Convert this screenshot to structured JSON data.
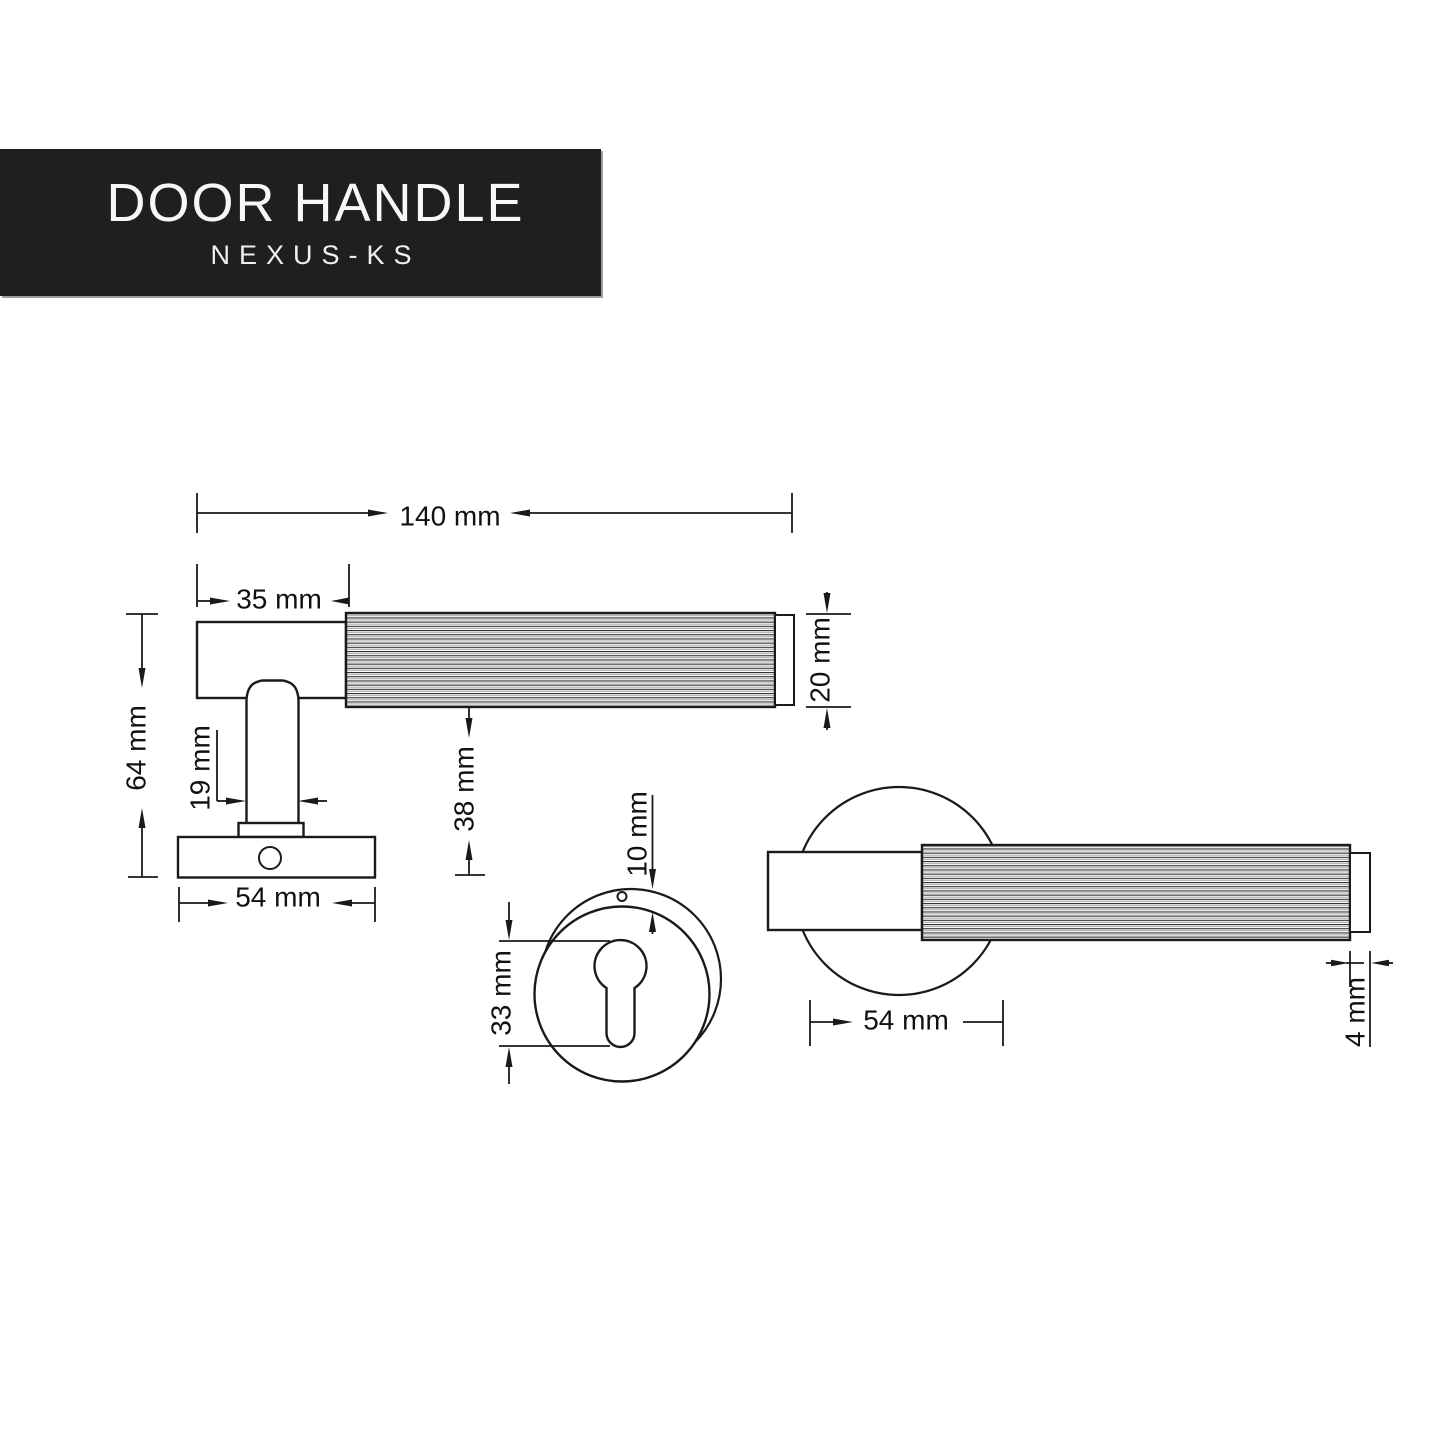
{
  "banner": {
    "title": "DOOR HANDLE",
    "subtitle": "NEXUS-KS"
  },
  "dims": {
    "total_length": "140 mm",
    "head_length": "35 mm",
    "side_height": "64 mm",
    "neck_width": "19 mm",
    "grip_diameter": "20 mm",
    "underside_offset": "38 mm",
    "rose_diameter_side": "54 mm",
    "keyhole_height": "33 mm",
    "rim_offset": "10 mm",
    "rose_diameter_plan": "54 mm",
    "cap_length": "4 mm"
  },
  "colors": {
    "banner_bg": "#1f1f1f",
    "banner_text": "#f7f7f7",
    "banner_shadow": "#9e9e9e",
    "line": "#1a1a1a",
    "canvas": "#ffffff"
  }
}
